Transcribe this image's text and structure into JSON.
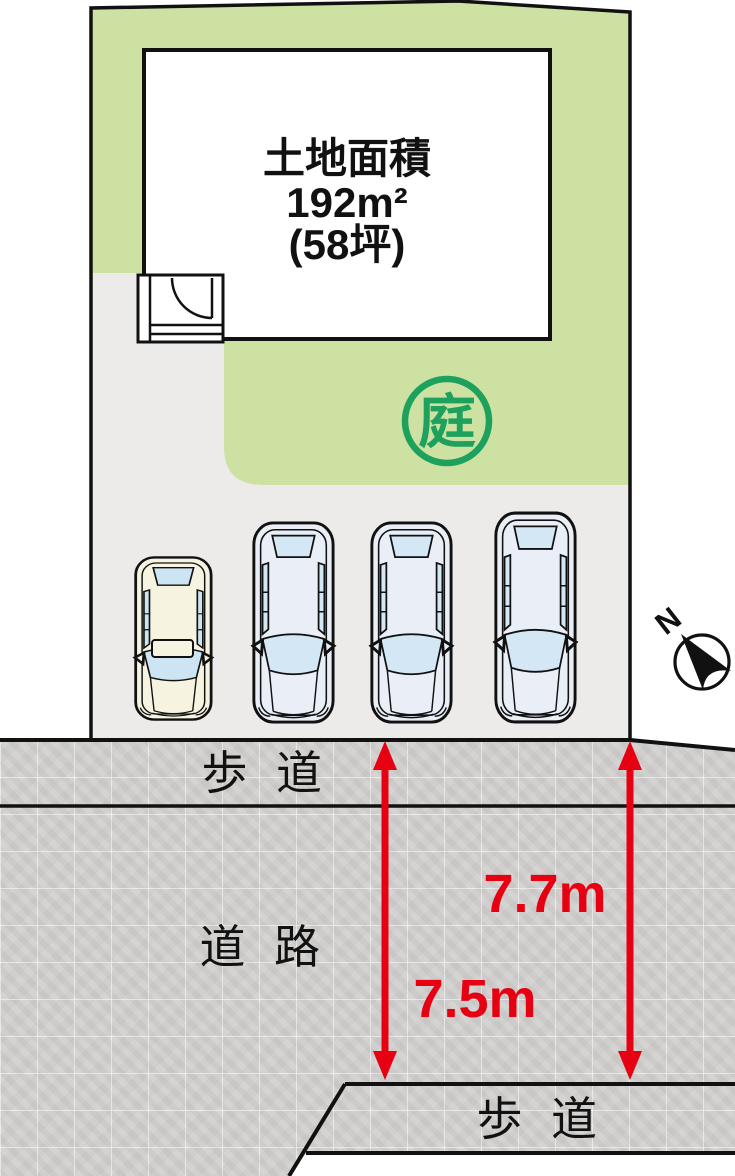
{
  "site_plan": {
    "land": {
      "area_label_title": "土地面積",
      "area_sqm": "192m²",
      "area_tsubo": "(58坪)"
    },
    "garden": {
      "badge": "庭",
      "color": "#1da15c"
    },
    "green_fill": "#cde2a2",
    "driveway_fill": "#ecebe9",
    "parking": {
      "car_count": 4
    },
    "compass": {
      "north": "N"
    }
  },
  "roads": {
    "upper_sidewalk_label": "歩道",
    "road_label": "道路",
    "lower_sidewalk_label": "歩道",
    "pavement_fill": "#d3d1cf"
  },
  "dimensions": {
    "left_arrow_value": "7.5m",
    "right_arrow_value": "7.7m",
    "color": "#e60012"
  }
}
